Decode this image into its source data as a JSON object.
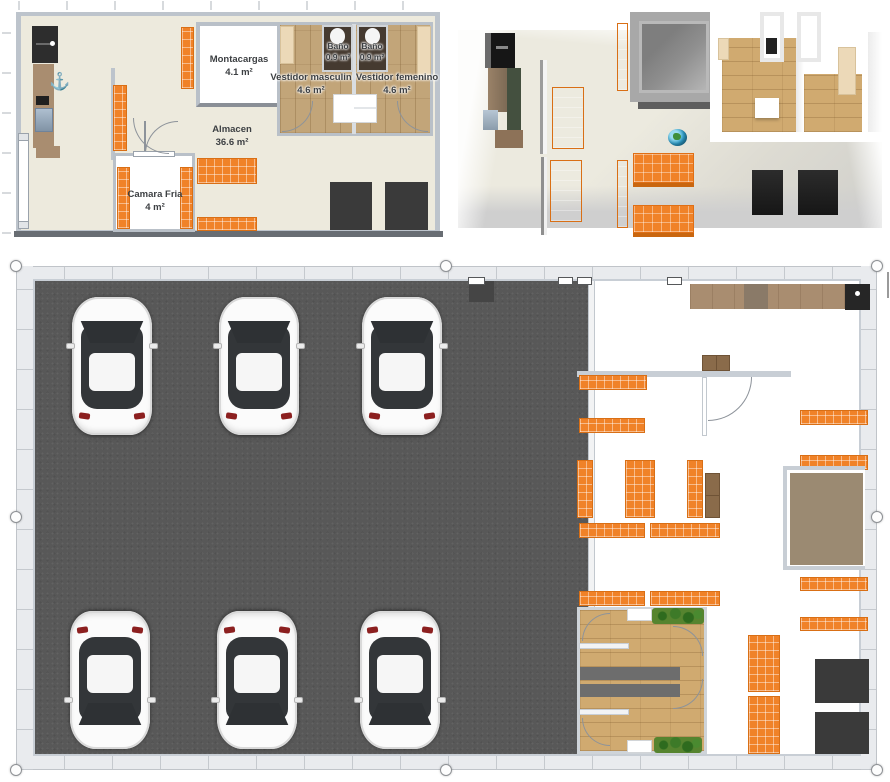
{
  "plan2d": {
    "rooms": [
      {
        "name": "Montacargas",
        "area": "4.1 m²"
      },
      {
        "name": "Baño",
        "area": "0.9 m²"
      },
      {
        "name": "Baño",
        "area": "0.9 m²"
      },
      {
        "name": "Vestidor masculin",
        "area": "4.6 m²"
      },
      {
        "name": "Vestidor femenino",
        "area": "4.6 m²"
      },
      {
        "name": "Almacen",
        "area": "36.6 m²"
      },
      {
        "name": "Camara Fria",
        "area": "4 m²"
      }
    ],
    "icons": {
      "anchor": "⚓"
    },
    "objects": [
      "refrigerator",
      "kitchen-counter",
      "window",
      "orange-shelving",
      "dark-appliance",
      "toilet",
      "locker",
      "bench",
      "door"
    ]
  },
  "view3d": {
    "objects": [
      "refrigerator",
      "tall-cabinet",
      "orange-shelving",
      "elevator-shaft",
      "orange-tables",
      "globe",
      "wood-floor-dressing-rooms",
      "lockers",
      "dark-appliances"
    ]
  },
  "plan_large": {
    "car_count": 6,
    "objects": [
      "parking-floor",
      "cars-top-view",
      "orange-shelving",
      "kitchen-counter",
      "dark-appliance",
      "interior-door",
      "storage-boxes",
      "work-table",
      "dressing-rooms",
      "benches",
      "plants",
      "window-markers"
    ]
  },
  "selection": {
    "handle_count": 8
  },
  "colors": {
    "shelf_orange": "#f08228",
    "floor_cream": "#edeadd",
    "wall_gray": "#bdc4cc",
    "parking_gray": "#585858",
    "wood_brown": "#c2a579",
    "appliance_dark": "#3a3a3a",
    "anchor_blue": "#2e6391",
    "plant_green": "#3d7a28",
    "table_brown": "#9b8a72"
  }
}
